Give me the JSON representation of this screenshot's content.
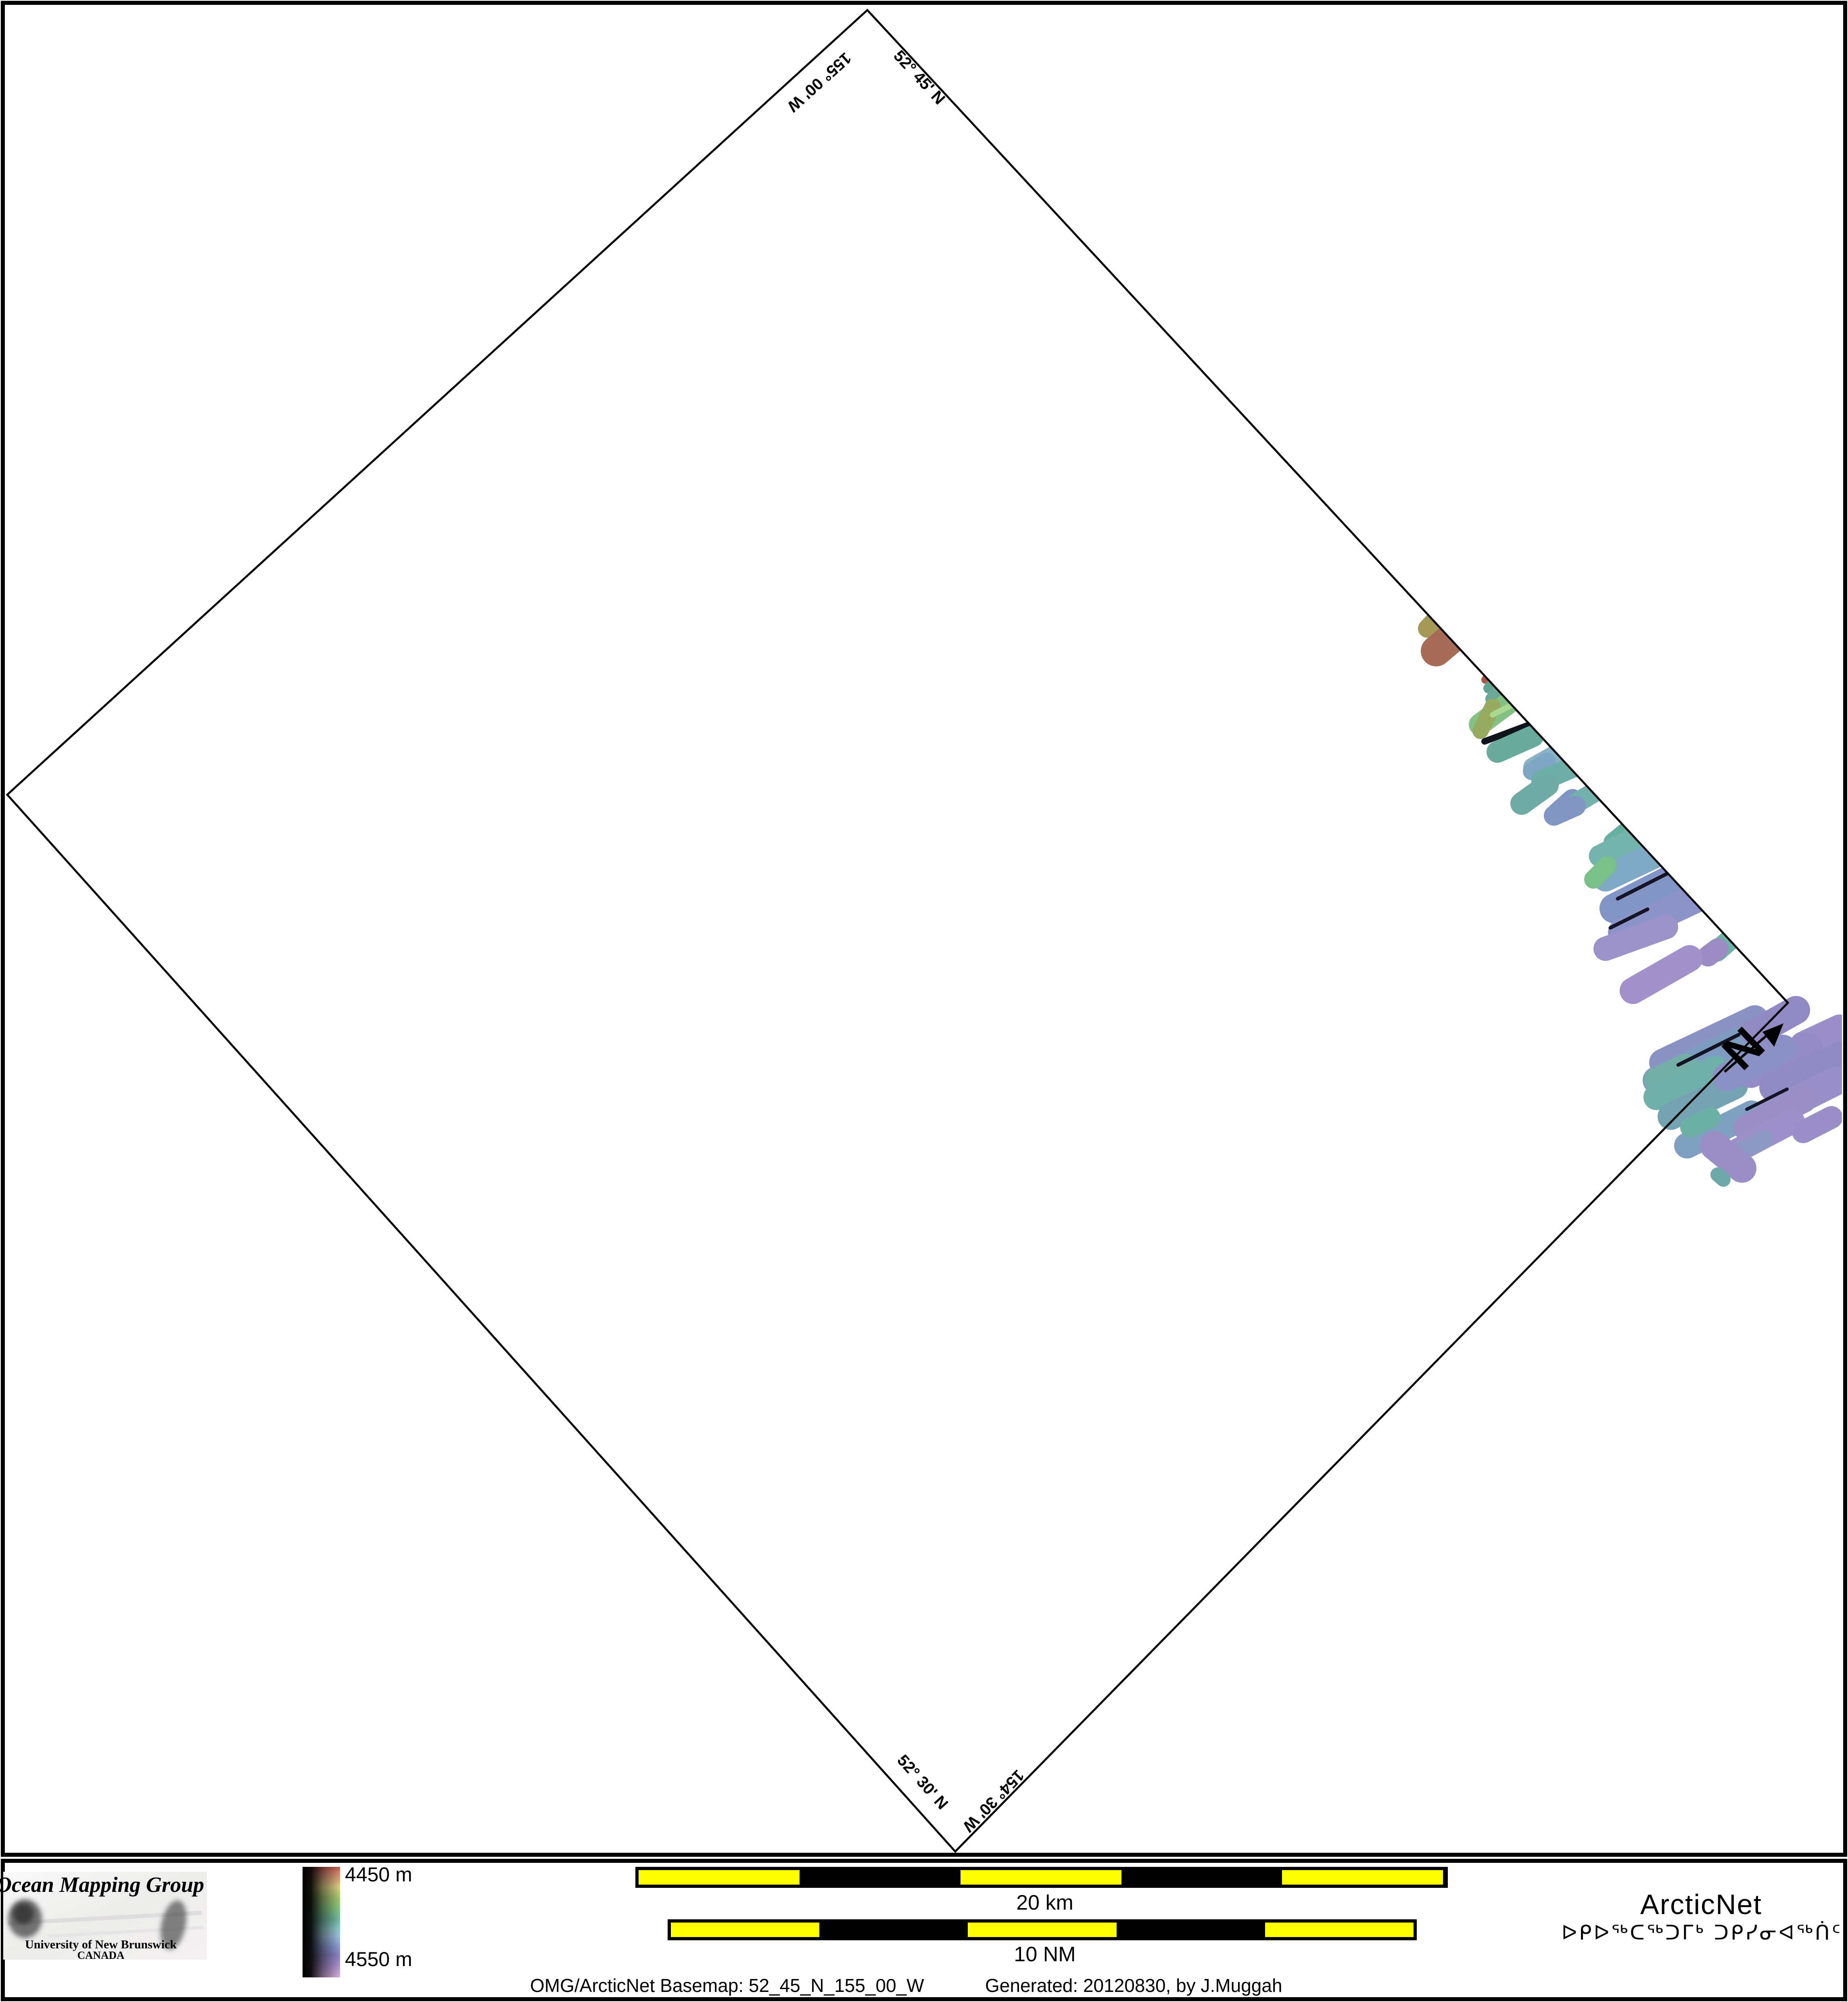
{
  "page": {
    "background": "#ffffff",
    "frame_color": "#000000"
  },
  "map": {
    "corner_labels": {
      "top_lat": "52° 45' N",
      "top_lon": "155° 00' W",
      "bottom_lat": "52° 30' N",
      "bottom_lon": "154° 30' W"
    },
    "north_label": "N",
    "swaths_in": [
      [
        3568,
        1526,
        3538,
        1558,
        46,
        "#a49857"
      ],
      [
        3612,
        1570,
        3560,
        1614,
        76,
        "#a86b58"
      ],
      [
        3690,
        1677,
        3682,
        1685,
        20,
        "#a85a48"
      ],
      [
        3704,
        1691,
        3690,
        1706,
        26,
        "#61a393"
      ],
      [
        3716,
        1711,
        3699,
        1733,
        34,
        "#6aa897"
      ],
      [
        3748,
        1737,
        3668,
        1796,
        54,
        "#83c184"
      ],
      [
        3700,
        1752,
        3670,
        1812,
        40,
        "#98aa60"
      ],
      [
        3762,
        1740,
        3700,
        1772,
        14,
        "#a8d98e"
      ],
      [
        3795,
        1795,
        3680,
        1838,
        16,
        "#10141c"
      ],
      [
        3800,
        1825,
        3712,
        1864,
        54,
        "#68aa9c"
      ],
      [
        3860,
        1868,
        3800,
        1902,
        48,
        "#89b3c7"
      ],
      [
        3835,
        1888,
        3797,
        1912,
        44,
        "#7fa6c2"
      ],
      [
        3920,
        1893,
        3822,
        1935,
        52,
        "#6fafa9"
      ],
      [
        3836,
        1946,
        3772,
        1992,
        56,
        "#6faaa4"
      ],
      [
        3898,
        1982,
        3860,
        2016,
        52,
        "#8095c2"
      ],
      [
        3972,
        1952,
        3912,
        1988,
        50,
        "#74b0ac"
      ],
      [
        3906,
        1998,
        3852,
        2022,
        50,
        "#8195c2"
      ],
      [
        4030,
        2062,
        3998,
        2088,
        46,
        "#66b0a2"
      ],
      [
        4060,
        2075,
        3966,
        2122,
        55,
        "#74b4ac"
      ],
      [
        4120,
        2112,
        3980,
        2178,
        64,
        "#7fa9c4"
      ],
      [
        4172,
        2166,
        4002,
        2252,
        74,
        "#8094c6"
      ],
      [
        4202,
        2228,
        4022,
        2312,
        72,
        "#8b93c8"
      ],
      [
        3984,
        2146,
        3950,
        2180,
        46,
        "#79c089"
      ],
      [
        4140,
        2162,
        4010,
        2228,
        9,
        "#151527"
      ],
      [
        4084,
        2254,
        3992,
        2300,
        9,
        "#151527"
      ],
      [
        4130,
        2298,
        3980,
        2352,
        60,
        "#9c93c8"
      ],
      [
        4288,
        2330,
        4256,
        2358,
        52,
        "#6fb2a8"
      ],
      [
        4258,
        2352,
        4234,
        2370,
        52,
        "#9a8cc2"
      ],
      [
        4188,
        2376,
        4048,
        2456,
        66,
        "#a291ca"
      ]
    ],
    "swaths_out": [
      [
        4350,
        2526,
        4122,
        2634,
        68,
        "#8a92c4"
      ],
      [
        4310,
        2580,
        4106,
        2678,
        68,
        "#7d9cc0"
      ],
      [
        4180,
        2644,
        4108,
        2678,
        64,
        "#74b0a8"
      ],
      [
        4252,
        2650,
        4106,
        2720,
        64,
        "#6fb0aa"
      ],
      [
        4300,
        2692,
        4142,
        2768,
        66,
        "#74a2b2"
      ],
      [
        4342,
        2760,
        4182,
        2840,
        64,
        "#7fa0c0"
      ],
      [
        4240,
        2770,
        4190,
        2795,
        50,
        "#6db0a6"
      ],
      [
        4310,
        2565,
        4160,
        2640,
        9,
        "#141426"
      ],
      [
        4452,
        2504,
        4352,
        2560,
        70,
        "#9189c2"
      ],
      [
        4560,
        2548,
        4470,
        2590,
        66,
        "#9a8fc8"
      ],
      [
        4480,
        2596,
        4340,
        2660,
        74,
        "#948bc6"
      ],
      [
        4564,
        2616,
        4396,
        2696,
        70,
        "#8f8ac4"
      ],
      [
        4420,
        2600,
        4280,
        2670,
        70,
        "#8a90c4"
      ],
      [
        4550,
        2680,
        4390,
        2760,
        72,
        "#988fc8"
      ],
      [
        4470,
        2726,
        4330,
        2796,
        66,
        "#9a90c6"
      ],
      [
        4444,
        2780,
        4300,
        2856,
        60,
        "#9e90ca"
      ],
      [
        4540,
        2770,
        4470,
        2806,
        56,
        "#9a8fc8"
      ],
      [
        4372,
        2824,
        4288,
        2866,
        46,
        "#8d99c2"
      ],
      [
        4250,
        2840,
        4318,
        2896,
        72,
        "#9b8dc6"
      ],
      [
        4258,
        2912,
        4272,
        2924,
        36,
        "#6fa8a8"
      ],
      [
        4430,
        2700,
        4330,
        2750,
        8,
        "#141426"
      ]
    ]
  },
  "legend": {
    "omg": {
      "title": "Ocean Mapping Group",
      "org": "University of New Brunswick",
      "country": "CANADA",
      "title_color": "#9e1c1c",
      "org_color": "#22228e"
    },
    "depth_scale": {
      "top_label": "4450 m",
      "bottom_label": "4550 m"
    },
    "bars": {
      "km_label": "20 km",
      "nm_label": "10 NM",
      "yellow": "#ffff00"
    },
    "arcticnet": {
      "name": "ArcticNet",
      "syllabics": "ᐅᑭᐅᖅᑕᖅᑐᒥᒃ ᑐᑭᓯᓂᐊᖅᑏᑦ",
      "name_color": "#74a9dc",
      "syllabics_color": "#344b63"
    },
    "caption_left": "OMG/ArcticNet Basemap: 52_45_N_155_00_W",
    "caption_right": "Generated: 20120830, by J.Muggah"
  }
}
